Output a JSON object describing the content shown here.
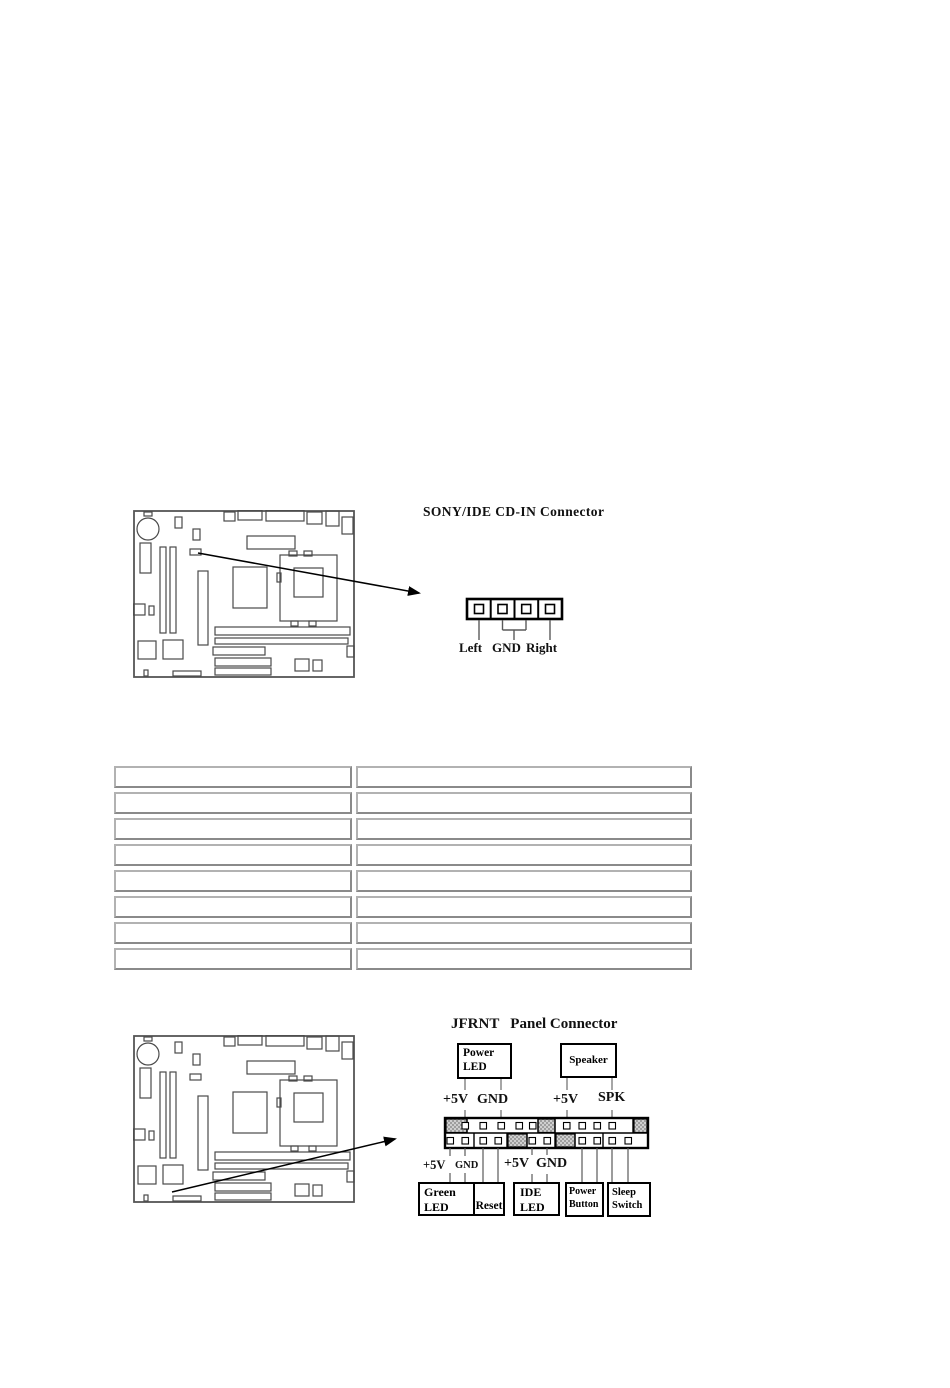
{
  "page": {
    "background": "#ffffff"
  },
  "cdin": {
    "title": "SONY/IDE CD-IN Connector",
    "pin_labels": [
      "Left",
      "GND",
      "Right"
    ],
    "pin_count": 4
  },
  "spec_table": {
    "columns": 2,
    "rows": [
      [
        "",
        ""
      ],
      [
        "",
        ""
      ],
      [
        "",
        ""
      ],
      [
        "",
        ""
      ],
      [
        "",
        ""
      ],
      [
        "",
        ""
      ],
      [
        "",
        ""
      ],
      [
        "",
        ""
      ]
    ]
  },
  "jfrnt": {
    "title": "JFRNT   Panel Connector",
    "power_led_label": "Power LED",
    "speaker_label": "Speaker",
    "top_pin_labels": [
      "+5V",
      "GND",
      "+5V",
      "SPK"
    ],
    "bottom_pin_labels": [
      "+5V",
      "GND",
      "+5V",
      "GND"
    ],
    "green_led_label": "Green LED",
    "reset_label": "Reset",
    "ide_led_label": "IDE LED",
    "power_button_label": "Power Button",
    "sleep_switch_label": "Sleep Switch"
  },
  "colors": {
    "diagram_line": "#000000",
    "board_outline": "#4a4a4a",
    "table_border": "#9a9a9a",
    "hatch_gray": "#9e9e9e"
  }
}
